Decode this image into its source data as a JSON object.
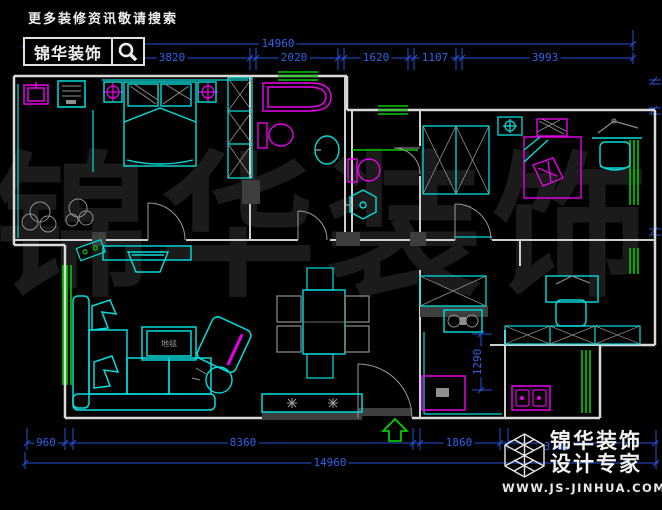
{
  "header": {
    "tagline": "更多装修资讯敬请搜索",
    "brand": "锦华装饰"
  },
  "watermark": "锦华装饰",
  "dims": {
    "top_overall": "14960",
    "top_segments": [
      "3820",
      "2020",
      "1620",
      "1107",
      "3993"
    ],
    "bottom_segments": [
      "960",
      "8360",
      "1860",
      "3780"
    ],
    "bottom_overall": "14960",
    "kitchen_vertical": "1290"
  },
  "plan": {
    "rug_label": "地毯"
  },
  "footer": {
    "brand_line1": "锦华装饰",
    "brand_line2": "设计专家",
    "website": "WWW.JS-JINHUA.COM"
  },
  "colors": {
    "wall": "#d9d9d9",
    "furniture": "#00dede",
    "fixture": "#e800e8",
    "window": "#00cc00",
    "dimension": "#2e63e8",
    "watermark": "#1b1b1b"
  }
}
